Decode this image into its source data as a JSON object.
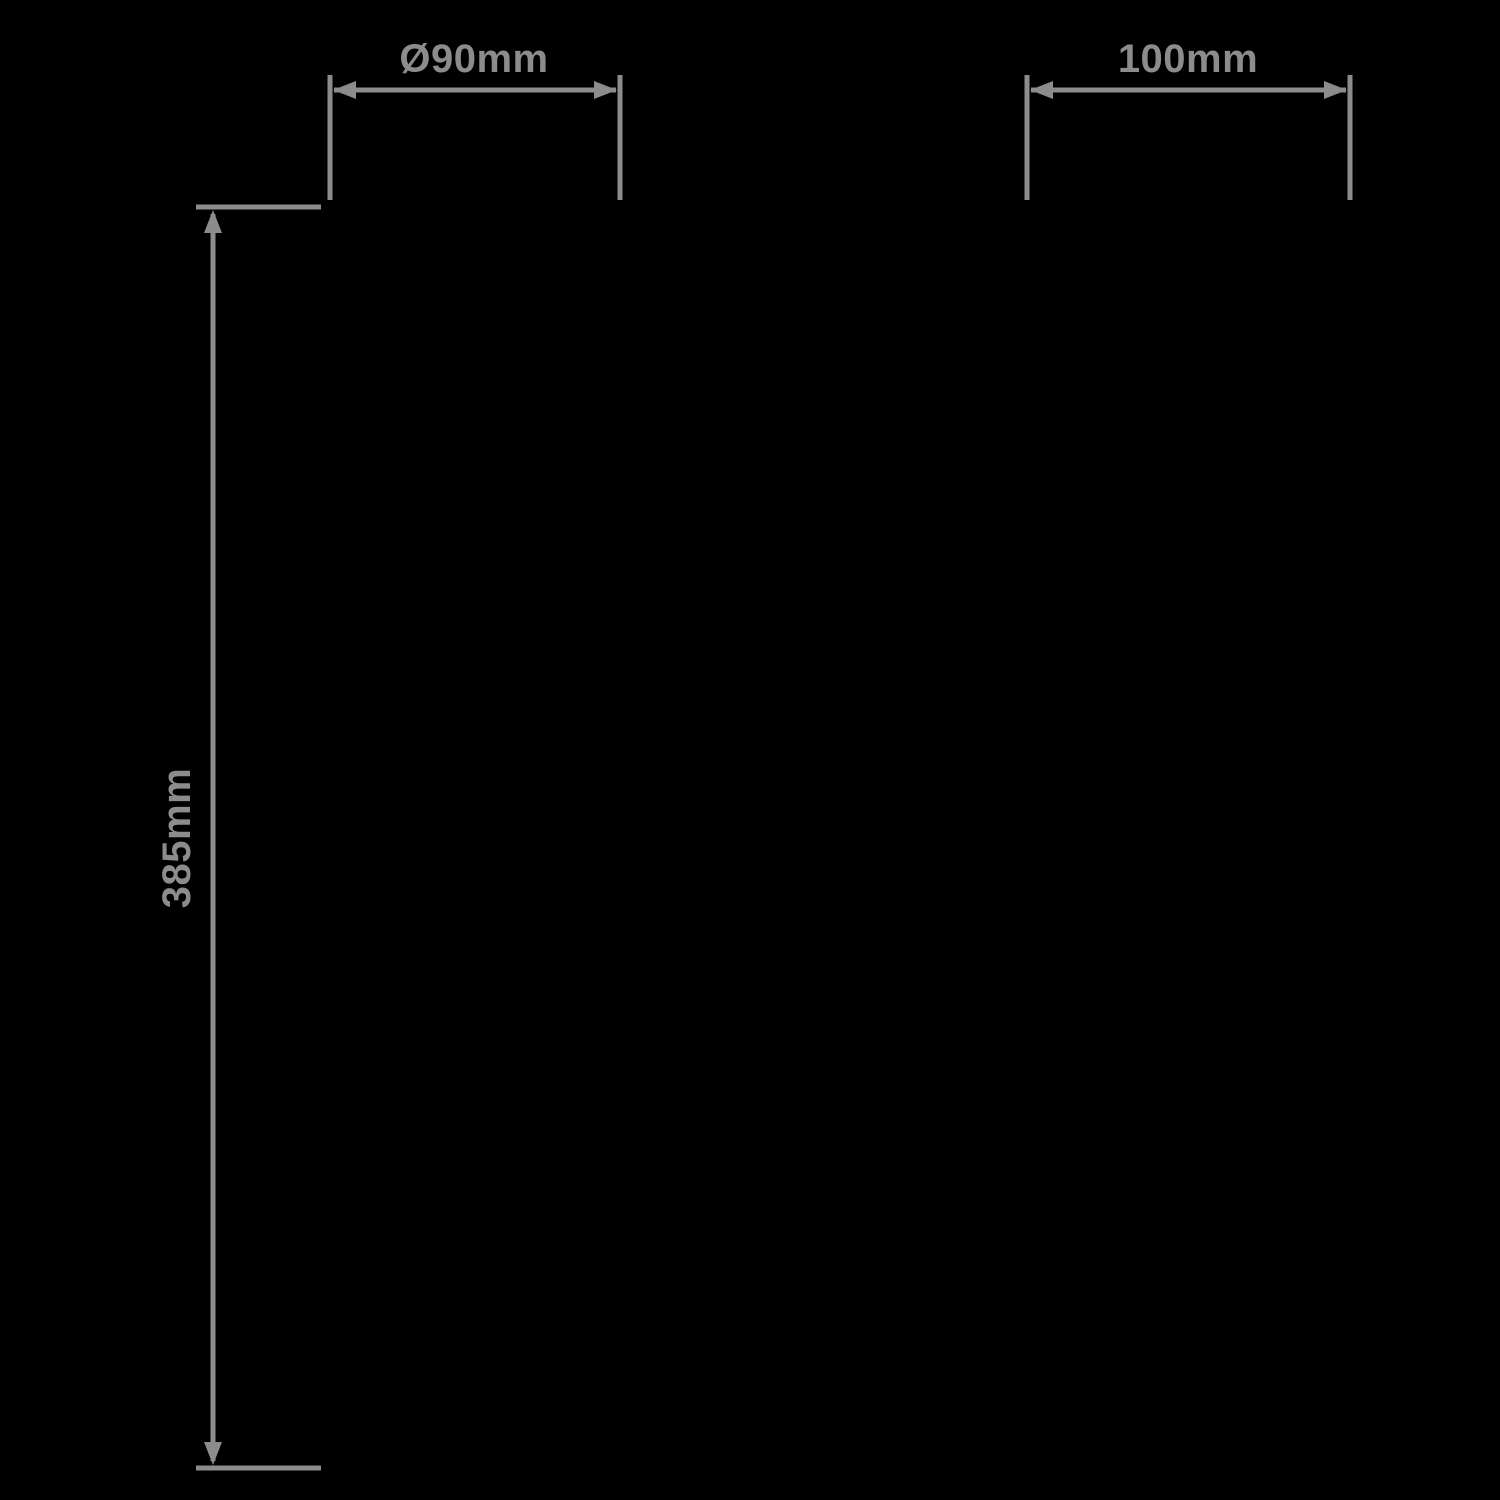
{
  "canvas": {
    "background": "#000000",
    "line_color": "#8c8c8c"
  },
  "dimensions": {
    "diameter": {
      "label": "Ø90mm"
    },
    "projection": {
      "label": "100mm"
    },
    "height": {
      "label": "385mm"
    }
  }
}
